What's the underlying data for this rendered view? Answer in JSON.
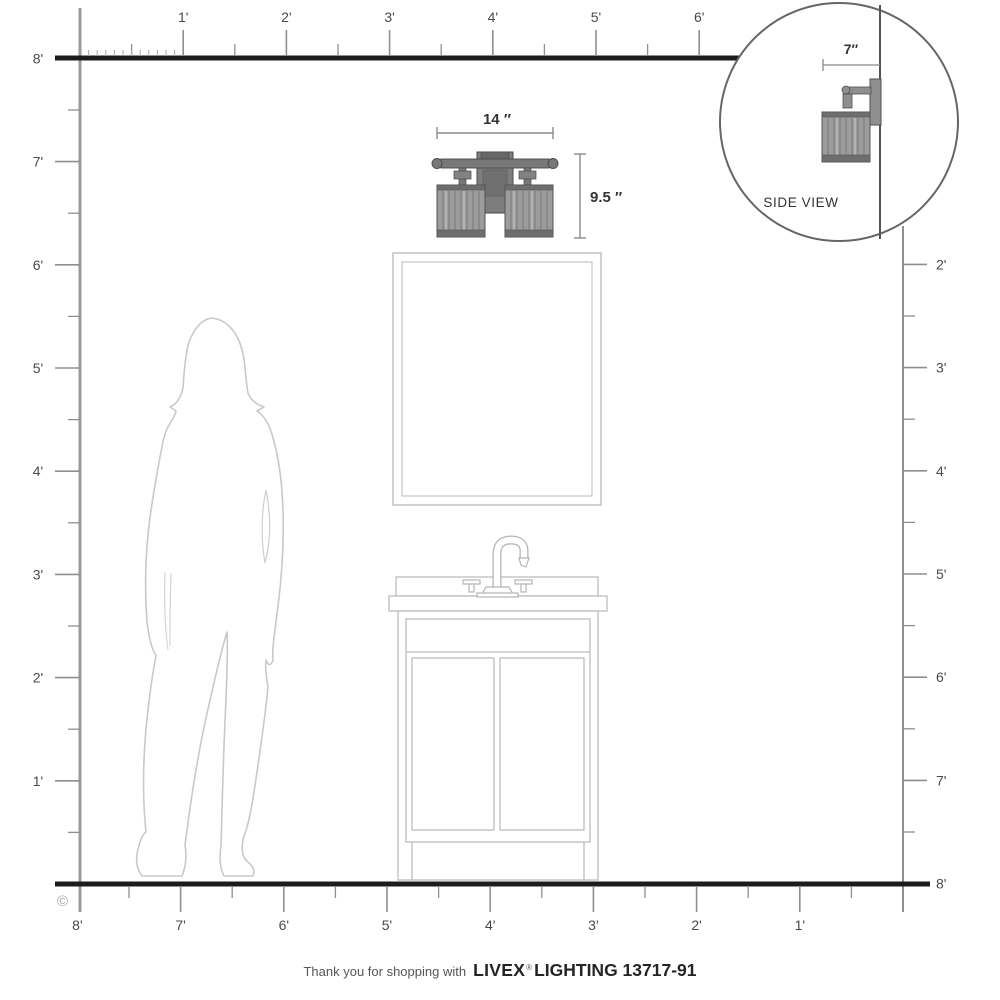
{
  "rulers": {
    "top_labels": [
      "1'",
      "2'",
      "3'",
      "4'",
      "5'",
      "6'"
    ],
    "left_labels": [
      "8'",
      "7'",
      "6'",
      "5'",
      "4'",
      "3'",
      "2'",
      "1'"
    ],
    "right_labels": [
      "2'",
      "3'",
      "4'",
      "5'",
      "6'",
      "7'",
      "8'"
    ],
    "bottom_labels": [
      "8'",
      "7'",
      "6'",
      "5'",
      "4'",
      "3'",
      "2'",
      "1'"
    ]
  },
  "dimensions": {
    "fixture_width": "14 ″",
    "fixture_height": "9.5 ″",
    "fixture_depth": "7″"
  },
  "inset": {
    "label": "SIDE VIEW"
  },
  "copyright_symbol": "©",
  "footer": {
    "prefix": "Thank you for shopping with",
    "brand": "LIVEX",
    "registered": "®",
    "model": "LIGHTING 13717-91"
  },
  "colors": {
    "wall_floor_line": "#1c1c1c",
    "ruler_line": "#8f8f8f",
    "ruler_text": "#4a4a4a",
    "artwork_outline": "#c6c6c6",
    "fixture_fill": "#9c9c9c",
    "fixture_dark": "#4f4f4f"
  }
}
